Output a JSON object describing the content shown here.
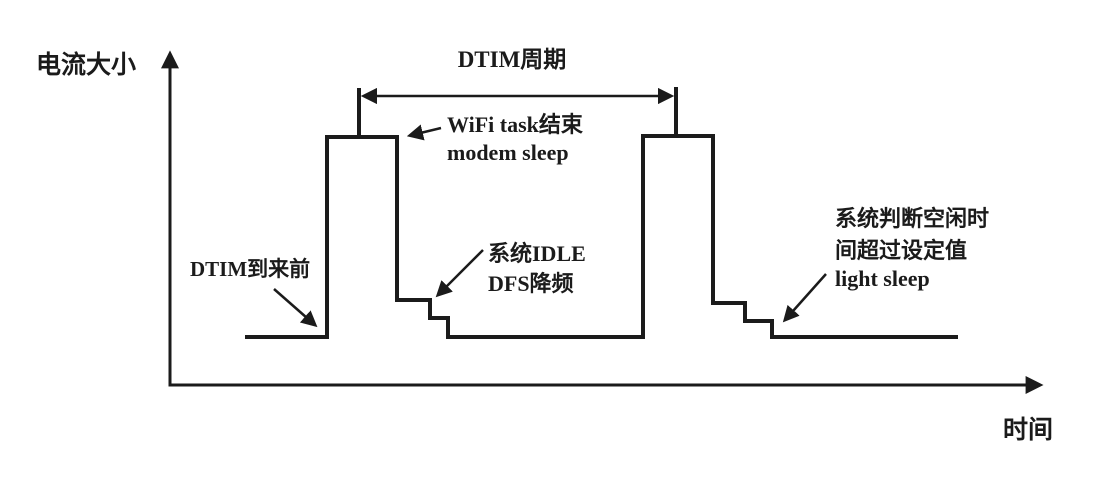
{
  "diagram": {
    "background": "#ffffff",
    "line_color": "#1b1b1b",
    "y_axis_label": "电流大小",
    "x_axis_label": "时间",
    "labels": {
      "dtim_period": "DTIM周期",
      "wifi_task_line1": "WiFi task结束",
      "wifi_task_line2": "modem sleep",
      "dtim_before": "DTIM到来前",
      "idle_line1": "系统IDLE",
      "idle_line2": "DFS降频",
      "light_sleep_line1": "系统判断空闲时",
      "light_sleep_line2": "间超过设定值",
      "light_sleep_line3": "light sleep"
    },
    "waveform": {
      "points": "245,337 327,337 327,137 397,137 397,300 430,300 430,318 448,318 448,337 643,337 643,136 713,136 713,303 745,303 745,321 772,321 772,337 958,337"
    },
    "dtim_span": {
      "y": 96,
      "x_start": 359,
      "x_end": 676
    }
  }
}
